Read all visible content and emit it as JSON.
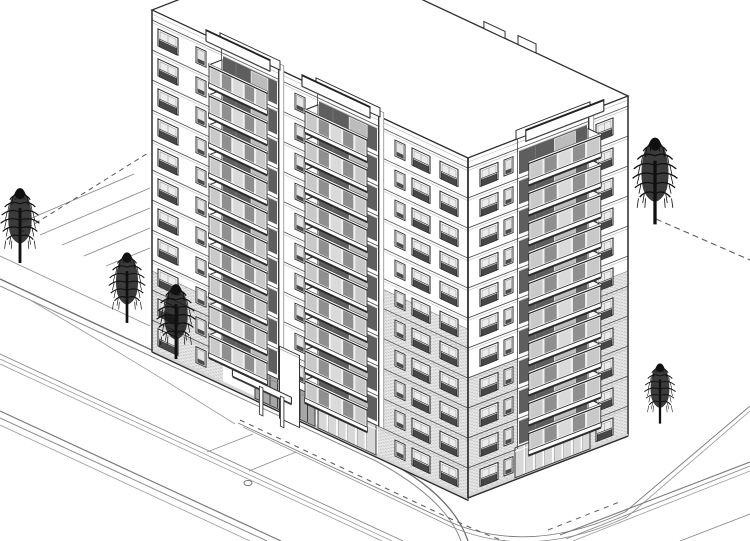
{
  "meta": {
    "label": "Axonometric architectural line rendering of an 11-storey corner apartment building with balconies, street, sidewalks, parking stalls and five trees"
  },
  "canvas": {
    "w": 750,
    "h": 541
  },
  "colors": {
    "bg": "#ffffff",
    "line": "#2f2f2f",
    "line_mid": "#555555",
    "line_light": "#b8b8b8",
    "wall": "#ffffff",
    "brick": "#e7e7e7",
    "brick_dot": "#c3c3c3",
    "glass_a": "#c9c9c9",
    "glass_b": "#8f8f8f",
    "glass_c": "#dadada",
    "interior": "#5e5e5e",
    "railing": "#474747",
    "shadow": "#2a2a2a",
    "tree": "#101010",
    "road": "#7a7a7a"
  },
  "building": {
    "floors": 11,
    "floor_h": 30,
    "parapet_h": 10,
    "roof": {
      "corners": [
        [
          468,
          158
        ],
        [
          152,
          10
        ],
        [
          312,
          -52
        ],
        [
          628,
          96
        ]
      ],
      "notches": [
        {
          "t0": 0.544,
          "t1": 0.611,
          "h": 7
        },
        {
          "t0": 0.652,
          "t1": 0.709,
          "h": 9
        }
      ]
    },
    "edges": {
      "corner": [
        [
          468,
          158
        ],
        [
          468,
          498
        ]
      ],
      "left": [
        [
          152,
          10
        ],
        [
          152,
          352
        ]
      ],
      "right": [
        [
          628,
          96
        ],
        [
          628,
          434
        ]
      ]
    },
    "left_facade": {
      "origin": [
        152,
        10
      ],
      "skew": 0.469,
      "width": 316,
      "height": 342,
      "balcony_offset": [
        -12,
        10.3
      ],
      "window_cols": [
        {
          "type": "wide_rail",
          "x": 6,
          "w": 20
        },
        {
          "type": "narrow",
          "x": 44,
          "w": 10
        },
        {
          "type": "narrow",
          "x": 143,
          "w": 10
        },
        {
          "type": "narrow",
          "x": 243,
          "w": 10
        },
        {
          "type": "wide_rail",
          "x": 260,
          "w": 18
        },
        {
          "type": "wide_rail",
          "x": 288,
          "w": 18
        }
      ],
      "stacks": [
        {
          "x": 70,
          "w": 56,
          "from": 2
        },
        {
          "x": 166,
          "w": 60,
          "from": 2
        }
      ],
      "brick": [
        {
          "x": 0,
          "w": 71,
          "top_ly": 261
        },
        {
          "x": 226,
          "w": 90,
          "top_ly": 171
        }
      ],
      "ground_glazing": [
        {
          "x": 103,
          "w": 60,
          "kind": "entrance"
        },
        {
          "x": 166,
          "w": 58,
          "kind": "storefront"
        }
      ],
      "skip_ground_cols_between": [
        100,
        166
      ],
      "canopy": {
        "slab": {
          "x": 99,
          "y": 306,
          "w": 59,
          "h": 6.5,
          "offset": [
            -18.6,
            15.9
          ]
        },
        "pylon": {
          "x": 135,
          "y": 270,
          "w": 20,
          "h": 72,
          "offset": [
            -7.5,
            6.4
          ]
        },
        "columns": [
          {
            "x": 126,
            "y": 310,
            "w": 3.5,
            "h": 28
          },
          {
            "x": 147,
            "y": 310,
            "w": 3.5,
            "h": 30
          }
        ]
      }
    },
    "right_facade": {
      "origin": [
        468,
        158
      ],
      "skew": -0.387,
      "width": 160,
      "height": 340,
      "balcony_offset": [
        11.8,
        10.1
      ],
      "window_cols": [
        {
          "type": "wide_rail",
          "x": 12,
          "w": 18
        },
        {
          "type": "narrow",
          "x": 36,
          "w": 9
        },
        {
          "type": "wide_rail",
          "x": 128,
          "w": 17
        }
      ],
      "stacks": [
        {
          "x": 50,
          "w": 70,
          "from": 2
        }
      ],
      "brick": [
        {
          "x": 0,
          "w": 50,
          "top_ly": 220
        },
        {
          "x": 120,
          "w": 40,
          "top_ly": 175
        }
      ],
      "ground_glazing": [
        {
          "x": 47,
          "w": 75,
          "kind": "storefront"
        }
      ],
      "skip_ground_cols_between": [
        46,
        122
      ]
    }
  },
  "trees": [
    {
      "x": 20,
      "y": 261,
      "s": 1.02
    },
    {
      "x": 127,
      "y": 321,
      "s": 0.96
    },
    {
      "x": 176,
      "y": 357,
      "s": 1.02
    },
    {
      "x": 655,
      "y": 222,
      "s": 1.18
    },
    {
      "x": 660,
      "y": 422,
      "s": 0.82
    }
  ],
  "ground": {
    "solid": [
      {
        "d": "M0,279 L382,458 Q452,494 468,541",
        "w": 1.3,
        "c": "#6f6f6f"
      },
      {
        "d": "M0,286 L376,461 Q446,499 461,541",
        "w": 1.0,
        "c": "#8b8b8b"
      },
      {
        "d": "M0,411 L281,541",
        "w": 1.2,
        "c": "#7a7a7a"
      },
      {
        "d": "M0,418 L267,541",
        "w": 1.0,
        "c": "#8b8b8b"
      },
      {
        "d": "M0,425 L250,541",
        "w": 0.8,
        "c": "#9c9c9c"
      },
      {
        "d": "M0,354 L403,541",
        "w": 0.9,
        "c": "#8b8b8b"
      },
      {
        "d": "M0,359 L392,541",
        "w": 0.8,
        "c": "#9c9c9c"
      },
      {
        "d": "M0,364 L382,541",
        "w": 0.8,
        "c": "#9c9c9c"
      },
      {
        "d": "M0,256 L150,326",
        "w": 0.8,
        "c": "#8f8f8f"
      },
      {
        "d": "M30,300 Q120,352 235,424",
        "w": 0.8,
        "c": "#9a9a9a"
      },
      {
        "d": "M238,423 L450,522 Q530,556 625,512 L750,406",
        "w": 0.9,
        "c": "#7d7d7d"
      },
      {
        "d": "M243,427 L452,527 Q532,561 627,517 L750,411",
        "w": 0.8,
        "c": "#939393"
      },
      {
        "d": "M560,535 L750,462",
        "w": 1.1,
        "c": "#7a7a7a"
      },
      {
        "d": "M566,539 L750,466",
        "w": 0.9,
        "c": "#8b8b8b"
      },
      {
        "d": "M573,541 L750,471",
        "w": 0.8,
        "c": "#9c9c9c"
      },
      {
        "d": "M680,541 L750,514",
        "w": 0.9,
        "c": "#8b8b8b"
      },
      {
        "d": "M253,434 L207,452",
        "w": 0.8,
        "c": "#8d8d8d"
      },
      {
        "d": "M296,452 L249,471",
        "w": 0.8,
        "c": "#8d8d8d"
      },
      {
        "d": "M18,224 L134,174",
        "w": 0.9,
        "c": "#8d8d8d"
      },
      {
        "d": "M40,235 L150,188",
        "w": 0.9,
        "c": "#8d8d8d"
      },
      {
        "d": "M62,245 L150,208",
        "w": 0.9,
        "c": "#8d8d8d"
      },
      {
        "d": "M84,256 L150,228",
        "w": 0.9,
        "c": "#8d8d8d"
      },
      {
        "d": "M106,266 L150,248",
        "w": 0.9,
        "c": "#8d8d8d"
      }
    ],
    "dashed": [
      {
        "d": "M20,233 L148,153",
        "w": 1.0,
        "c": "#5a5a5a",
        "dash": "5,4"
      },
      {
        "d": "M240,420 L447,517 Q495,539 505,541",
        "w": 1.1,
        "c": "#5f5f5f",
        "dash": "5,5"
      },
      {
        "d": "M548,530 L622,501",
        "w": 1.0,
        "c": "#5f5f5f",
        "dash": "5,5"
      },
      {
        "d": "M656,219 L750,260",
        "w": 1.0,
        "c": "#5a5a5a",
        "dash": "6,4"
      }
    ],
    "manhole": {
      "cx": 248,
      "cy": 483,
      "rx": 4,
      "ry": 2.6
    }
  }
}
